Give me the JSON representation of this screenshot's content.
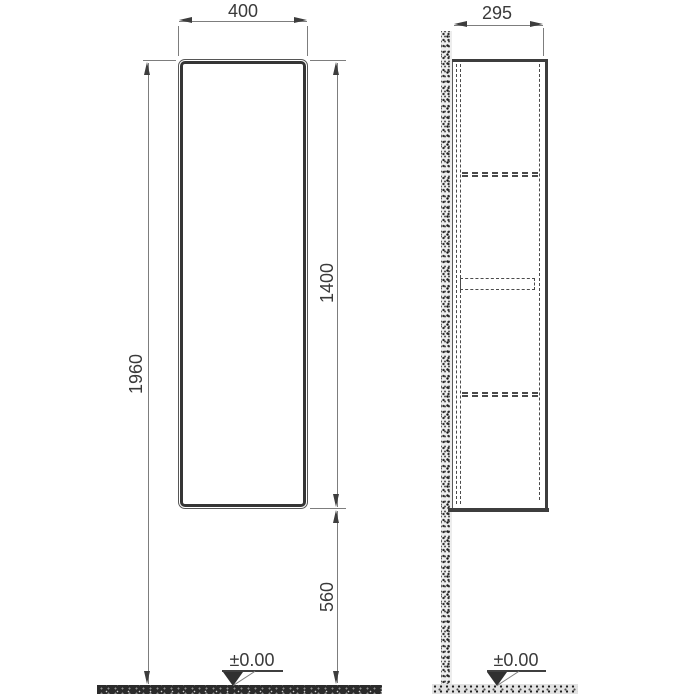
{
  "labels": {
    "width": "400",
    "depth": "295",
    "height_total": "1960",
    "height_cabinet": "1400",
    "height_from_floor": "560",
    "datum_front": "±0.00",
    "datum_side": "±0.00"
  },
  "colors": {
    "outline": "#3d3d3d",
    "dimension_line": "#7d7d7d",
    "hidden_line": "#4a4a4a",
    "background": "#ffffff"
  },
  "drawing": {
    "type": "furniture-technical-drawing",
    "views": [
      "front-elevation",
      "side-section"
    ],
    "units_mm": {
      "cabinet_width": 400,
      "cabinet_depth": 295,
      "overall_height": 1960,
      "cabinet_height": 1400,
      "clearance_below": 560,
      "floor_level": 0
    }
  }
}
